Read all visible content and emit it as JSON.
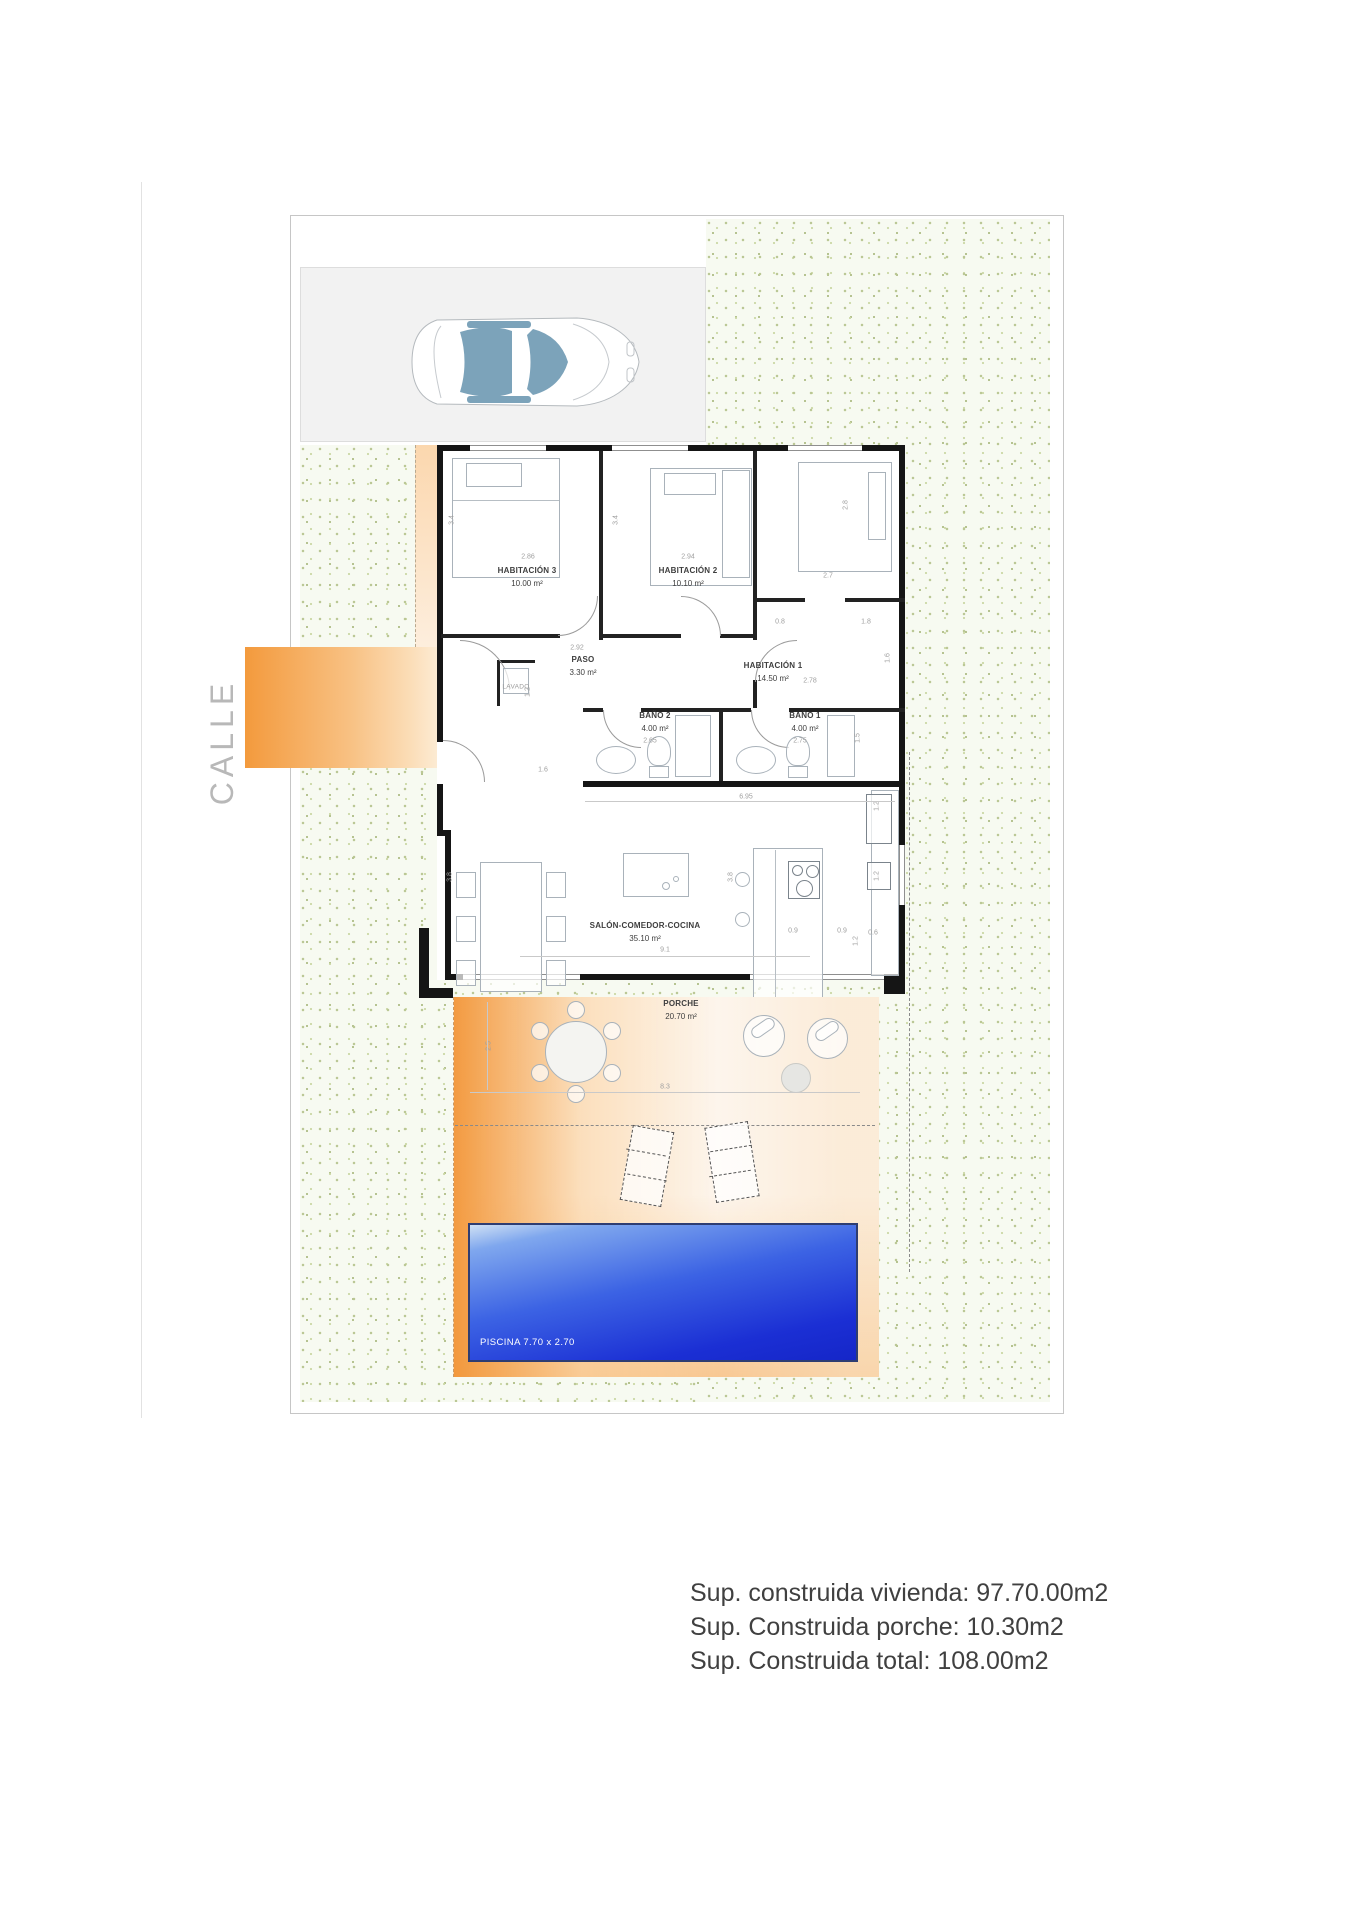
{
  "street": {
    "label": "CALLE"
  },
  "plot": {
    "rooms": {
      "hab3": {
        "name": "HABITACIÓN 3",
        "area": "10.00 m²"
      },
      "hab2": {
        "name": "HABITACIÓN 2",
        "area": "10.10 m²"
      },
      "hab1": {
        "name": "HABITACIÓN 1",
        "area": "14.50 m²"
      },
      "paso": {
        "name": "PASO",
        "area": "3.30 m²"
      },
      "bano2": {
        "name": "BAÑO 2",
        "area": "4.00 m²"
      },
      "bano1": {
        "name": "BAÑO 1",
        "area": "4.00 m²"
      },
      "salon": {
        "name": "SALÓN-COMEDOR-COCINA",
        "area": "35.10 m²"
      },
      "porche": {
        "name": "PORCHE",
        "area": "20.70 m²"
      },
      "lavado": {
        "name": "LAVADO"
      }
    },
    "pool": {
      "label": "PISCINA 7.70 x 2.70"
    }
  },
  "dims": {
    "d34a": "3.4",
    "d286": "2.86",
    "d34b": "3.4",
    "d294": "2.94",
    "d28": "2.8",
    "d27": "2.7",
    "d08": "0.8",
    "d18": "1.8",
    "d16a": "1.6",
    "d292": "2.92",
    "d12a": "1.2",
    "d278": "2.78",
    "d265": "2.65",
    "d275": "2.75",
    "d15": "1.5",
    "d16b": "1.6",
    "d695": "6.95",
    "d38a": "3.8",
    "d38b": "3.8",
    "d91": "9.1",
    "d09a": "0.9",
    "d09b": "0.9",
    "d06": "0.6",
    "d12b": "1.2",
    "d12c": "1.2",
    "d12d": "1.2",
    "d25": "2.5",
    "d83": "8.3"
  },
  "summary": {
    "line1": "Sup. construida vivienda: 97.70.00m2",
    "line2": "Sup. Construida porche: 10.30m2",
    "line3": "Sup. Construida total: 108.00m2"
  },
  "colors": {
    "accent_orange": "#f39a3d",
    "pool_blue": "#1b2fd4",
    "garden_green": "#f7faf1"
  }
}
